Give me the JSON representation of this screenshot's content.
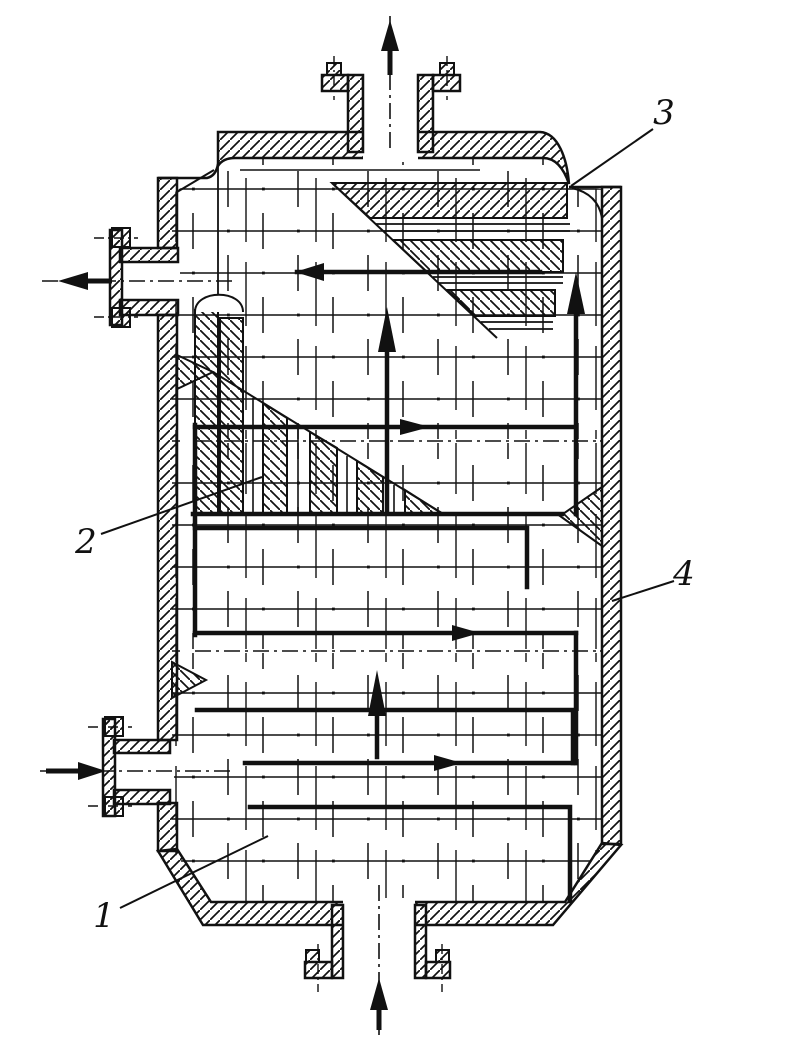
{
  "drawing": {
    "background_color": "#ffffff",
    "ink_color": "#111111",
    "labels": {
      "part1": "1",
      "part2": "2",
      "part3": "3",
      "part4": "4"
    },
    "icons": [
      "vapor-outlet-arrow-up-icon",
      "liquid-outlet-arrow-left-icon",
      "feed-inlet-arrow-right-icon",
      "bottom-inlet-arrow-up-icon",
      "internal-circulation-arrow-icons"
    ]
  }
}
